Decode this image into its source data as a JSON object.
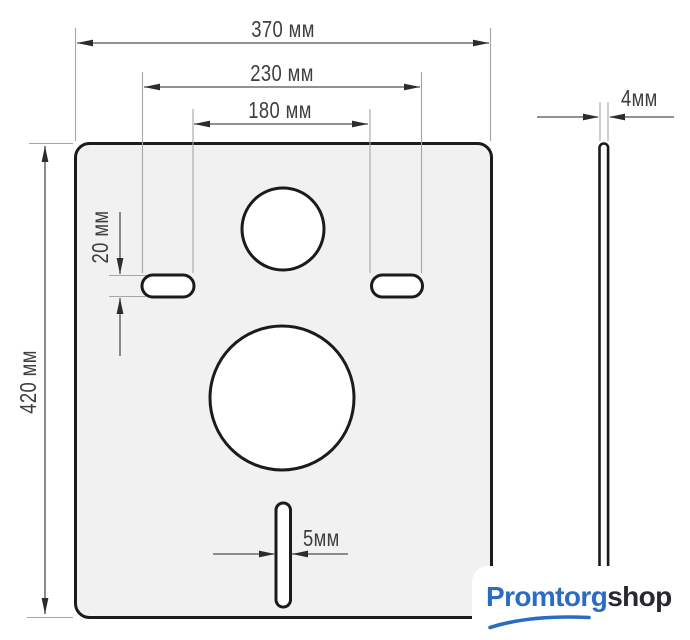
{
  "diagram": {
    "front_view": {
      "labels": {
        "plate_width": "370 мм",
        "holes_outer_span": "230 мм",
        "holes_inner_span": "180 мм",
        "plate_height": "420 мм",
        "oval_hole_height": "20 мм",
        "slot_width": "5мм"
      }
    },
    "side_view": {
      "labels": {
        "thickness": "4мм"
      }
    },
    "colors": {
      "plate_fill": "#f1f1f2",
      "outline": "#1b1b1b",
      "dimension_line": "#4f4f4f",
      "extension_line": "#a6a6a6",
      "label_text": "#3d3d3d"
    }
  },
  "logo": {
    "primary": "Promtorg",
    "secondary": "shop",
    "primary_color": "#2a6cc4",
    "secondary_color": "#27292c"
  }
}
